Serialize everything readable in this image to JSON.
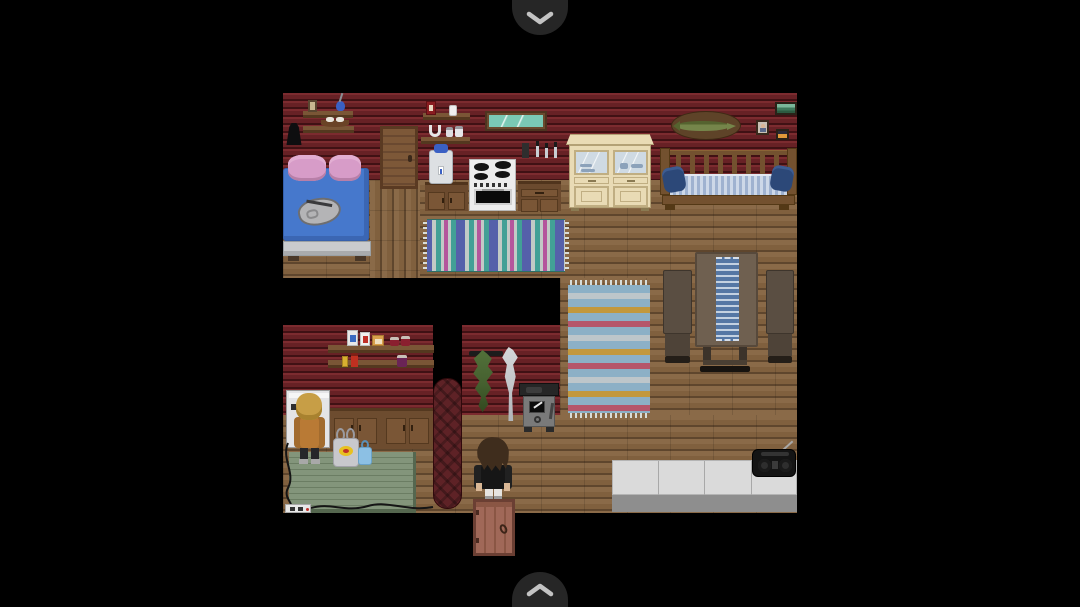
{
  "app": {
    "background_color": "#000000",
    "view": "pixel-art cabin interior game scene"
  },
  "nav": {
    "scroll_up_button": {
      "icon": "chevron-down-icon",
      "bg": "#262626",
      "glyph_color": "#c3c3c3"
    },
    "scroll_down_button": {
      "icon": "chevron-up-icon",
      "bg": "#262626",
      "glyph_color": "#c3c3c3"
    }
  },
  "palette": {
    "wall-log-light": "#7c2b2f",
    "wall-log-mid": "#672125",
    "wall-log-seam": "#401114",
    "floor-plank": "#8a6a48",
    "floor-plank-alt": "#80603e",
    "floor-seam": "#5f462d",
    "shelf-wood": "#7a5636",
    "shelf-wood-dark": "#54381f",
    "door-wood": "#7d5838",
    "door-frame": "#5a3a22",
    "exit-door-wood": "#a06858",
    "exit-door-frame": "#6b3f33",
    "bed-blanket": "#4678cc",
    "bed-pillow": "#d79cc8",
    "bed-frame": "#c9cbcd",
    "rug-teal": "#42a096",
    "rug-gray": "#c2cac6",
    "rug-indigo": "#5560aa",
    "rug-magenta": "#b4569c",
    "rug2-base": "#8cb0c6",
    "rug2-white": "#bdc6ca",
    "rug2-gold": "#c2983d",
    "rug2-red": "#b5566b",
    "cooler-white": "#dde0e3",
    "cooler-blue": "#3a60c4",
    "stove-white": "#ededed",
    "burner-black": "#141414",
    "counter-wood": "#6b4a2e",
    "counter-wood-light": "#7a5636",
    "hutch-cream": "#e9dbb5",
    "hutch-trim": "#c0ae82",
    "hutch-glass": "#cfdae3",
    "hutch-dish": "#8ca2ba",
    "plaque-brown": "#5e4328",
    "fish-olive": "#75854a",
    "fish-olive-dark": "#55632f",
    "daybed-wood": "#73512f",
    "daybed-wood-dark": "#543916",
    "mattress-light": "#cdd8e8",
    "mattress-blue": "#9fb2d0",
    "pillow-navy": "#2c4878",
    "table-top": "#6f6050",
    "table-dark": "#4a3f33",
    "chair-wood": "#5a4e42",
    "runner-blue": "#5577a4",
    "runner-light": "#c3d1e1",
    "counter-white": "#dadada",
    "counter-base": "#8e8e8e",
    "stove2-body": "#7a7a7a",
    "stove2-dark": "#262626",
    "sausage-red": "#5e2226",
    "vine-green": "#45602f",
    "fish2-gray": "#c6c9cb",
    "table-green": "#83957b",
    "table-green-line": "#6b7d63",
    "cabinet-wood": "#6d4c2f",
    "machine-white": "#e4e4e6",
    "npc-hair": "#c79e46",
    "npc-jacket": "#b97a35",
    "player-hair": "#3f2d1d",
    "player-jacket": "#161616",
    "skin": "#d9b795",
    "chevron-bg": "#262626",
    "chevron-glyph": "#c3c3c3",
    "bag-gray": "#c8c8cc",
    "bag-blue": "#8cc0e4",
    "glass-teal": "#7ac9b5"
  },
  "labels": {
    "viewport": "log cabin interior map",
    "bed": "bed with blue blanket and pink pillows",
    "satchel": "gray satchel on bed",
    "hanging_coat": "black coat hanging on wall",
    "trinket_shelf": "wall shelf with picture, vase and shoes",
    "wooden_door": "interior wooden door",
    "supply_shelf": "wall shelf with box, bottle, horseshoe and jars",
    "mirror": "wall mirror",
    "knife_rack": "knife rack",
    "water_cooler": "water cooler on cabinet",
    "kitchen_counter": "kitchen cabinets",
    "cooking_stove": "white cooking stove",
    "china_hutch": "china hutch with glass doors",
    "mounted_fish": "mounted pike trophy",
    "portrait_picture": "small portrait picture",
    "landscape_painting": "landscape painting",
    "lantern_picture": "small lantern picture",
    "daybed": "wooden daybed with striped mattress and navy pillows",
    "teal_rug": "striped teal rug",
    "dining_table": "dining table with blue runner",
    "chair": "wooden chair",
    "striped_rug": "striped blue rug",
    "food_shelf": "pantry shelf with flour, sugar, crackers and jars",
    "washing_machine": "washing machine",
    "npc": "blonde villager in orange jacket",
    "kitchen_cabinets": "lower kitchen cabinets",
    "green_table": "green work table",
    "gray_bag": "gray shopping bag",
    "blue_bag": "blue shopping bag",
    "power_strip": "power strip with cable",
    "sausage_column": "hanging sausage links in doorway",
    "hop_vine": "drying herb bundle",
    "dried_fish": "drying fish on hook",
    "wood_stove": "iron wood stove",
    "player": "player character in black jacket",
    "exit_door": "exit door at bottom",
    "white_counter": "long white counter",
    "boombox": "black boombox with antenna",
    "scroll_up": "scroll view up",
    "scroll_down": "scroll view down"
  },
  "scene": {
    "rooms": [
      "bedroom-kitchen",
      "dining-area",
      "pantry-laundry"
    ],
    "characters": [
      {
        "name": "npc-blonde",
        "hair": "#c79e46",
        "jacket": "#b97a35",
        "position": "facing washing machine"
      },
      {
        "name": "player",
        "hair": "#3f2d1d",
        "jacket": "#161616",
        "position": "standing above exit door"
      }
    ]
  }
}
